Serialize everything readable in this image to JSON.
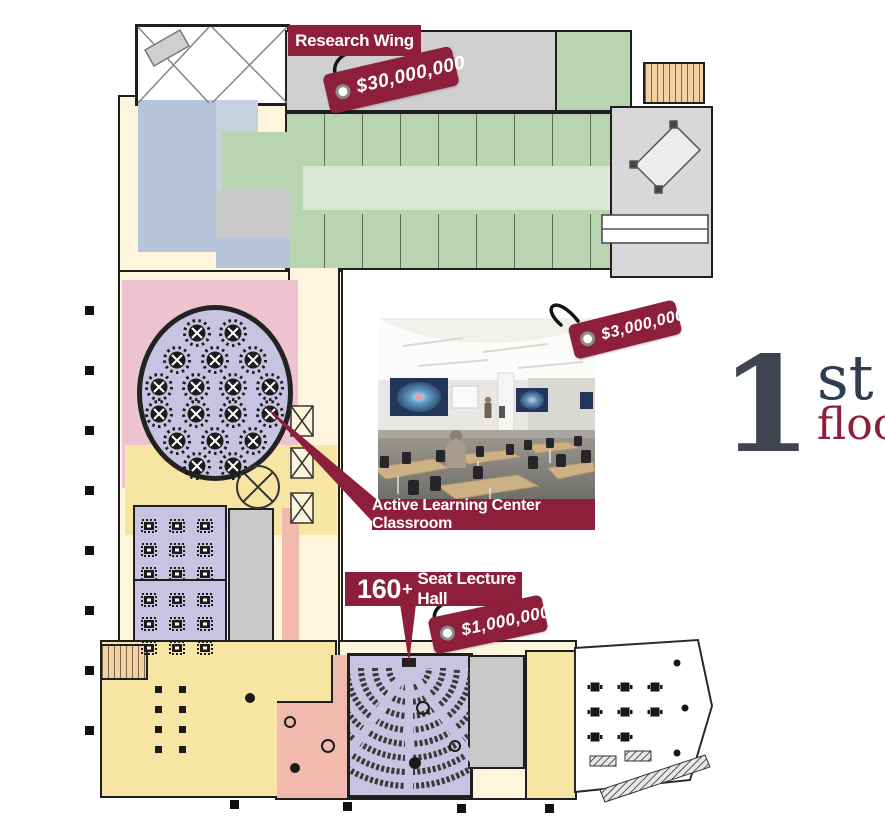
{
  "floor_indicator": {
    "number": "1",
    "ordinal": "st",
    "word": "floor"
  },
  "callouts": {
    "research_wing": {
      "label": "Research Wing",
      "price": "$30,000,000"
    },
    "active_learning_classroom": {
      "label": "Active Learning Center Classroom",
      "price": "$3,000,000"
    },
    "lecture_hall": {
      "seat_count": "160",
      "plus": "+",
      "label": "Seat Lecture Hall",
      "price": "$1,000,000"
    }
  },
  "colors": {
    "maroon": "#8e1f3c",
    "lab_green": "#b9d4b0",
    "room_blue": "#b5c4d9",
    "room_pink": "#ecc3ce",
    "room_salmon": "#f2b9ae",
    "room_lavender": "#c7c3e1",
    "room_yellow": "#f6e5a3",
    "corridor_cream": "#fdf6dc",
    "room_gray": "#cbcbcb",
    "stair_tan": "#f3d2a2",
    "wall": "#1f1f1f",
    "floor_number_gray": "#3e4551"
  }
}
